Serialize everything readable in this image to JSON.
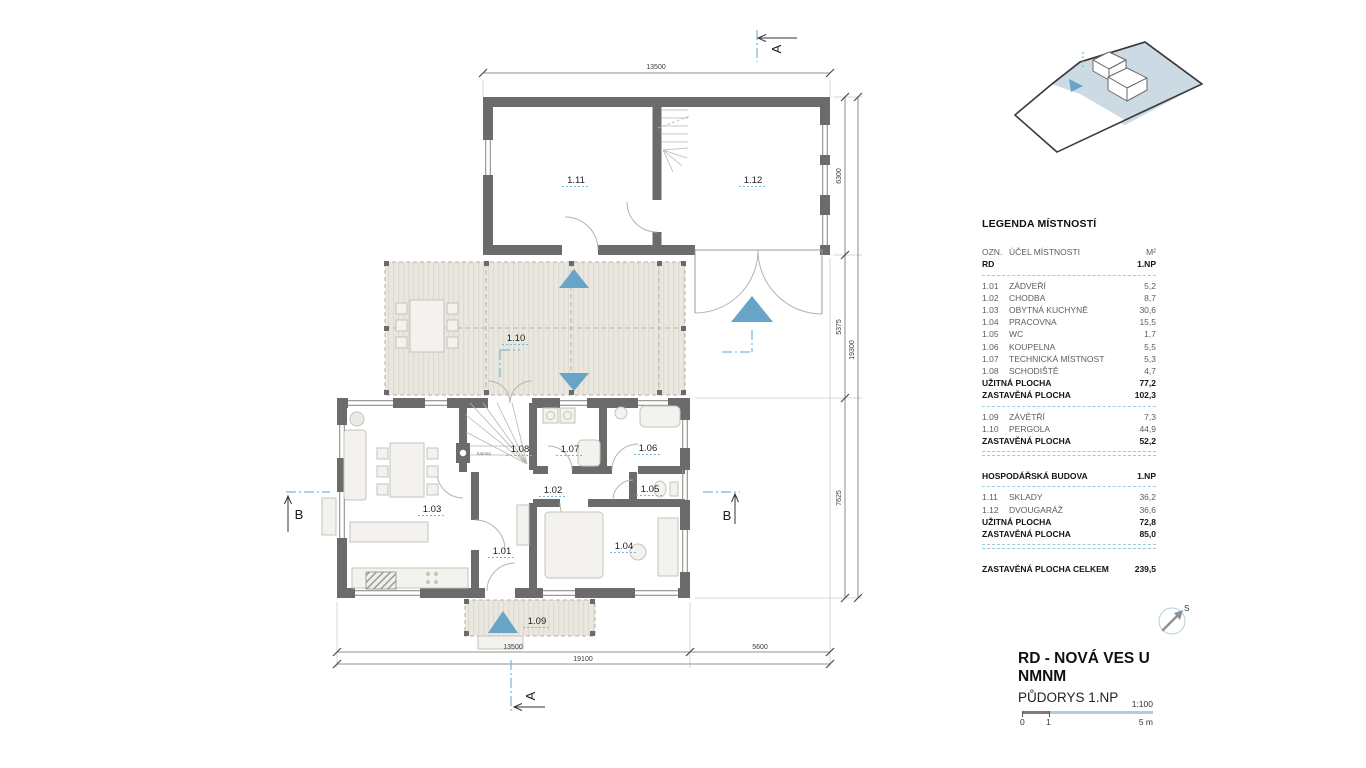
{
  "colors": {
    "wall": "#6b6b6b",
    "accent_blue": "#68a4c8",
    "reference_blue": "#79b6d9",
    "deck_fill": "#eae7e0"
  },
  "plan": {
    "rooms": {
      "r01": "1.01",
      "r02": "1.02",
      "r03": "1.03",
      "r04": "1.04",
      "r05": "1.05",
      "r06": "1.06",
      "r07": "1.07",
      "r08": "1.08",
      "r09": "1.09",
      "r10": "1.10",
      "r11": "1.11",
      "r12": "1.12"
    },
    "stove_label": "kamna",
    "dimensions": {
      "top_width": "13500",
      "right_upper": "6300",
      "right_middle": "5375",
      "right_lower": "7625",
      "right_total": "19300",
      "bottom_house": "13500",
      "bottom_gap": "5600",
      "bottom_total": "19100"
    },
    "sections": {
      "a": "A",
      "b": "B"
    }
  },
  "legend": {
    "title": "LEGENDA MÍSTNOSTÍ",
    "columns": {
      "ozn": "OZN.",
      "name": "ÚČEL MÍSTNOSTI",
      "area": "M²"
    },
    "rd": {
      "label": "RD",
      "floor": "1.NP",
      "rows": [
        {
          "code": "1.01",
          "name": "ZÁDVEŘÍ",
          "area": "5,2"
        },
        {
          "code": "1.02",
          "name": "CHODBA",
          "area": "8,7"
        },
        {
          "code": "1.03",
          "name": "OBYTNÁ KUCHYNĚ",
          "area": "30,6"
        },
        {
          "code": "1.04",
          "name": "PRACOVNA",
          "area": "15,5"
        },
        {
          "code": "1.05",
          "name": "WC",
          "area": "1,7"
        },
        {
          "code": "1.06",
          "name": "KOUPELNA",
          "area": "5,5"
        },
        {
          "code": "1.07",
          "name": "TECHNICKÁ MÍSTNOST",
          "area": "5,3"
        },
        {
          "code": "1.08",
          "name": "SCHODIŠTĚ",
          "area": "4,7"
        }
      ],
      "usable": {
        "label": "UŽITNÁ PLOCHA",
        "value": "77,2"
      },
      "builtup": {
        "label": "ZASTAVĚNÁ PLOCHA",
        "value": "102,3"
      }
    },
    "exterior": {
      "rows": [
        {
          "code": "1.09",
          "name": "ZÁVĚTŘÍ",
          "area": "7,3"
        },
        {
          "code": "1.10",
          "name": "PERGOLA",
          "area": "44,9"
        }
      ],
      "builtup": {
        "label": "ZASTAVĚNÁ PLOCHA",
        "value": "52,2"
      }
    },
    "outbuilding": {
      "label": "HOSPODÁŘSKÁ BUDOVA",
      "floor": "1.NP",
      "rows": [
        {
          "code": "1.11",
          "name": "SKLADY",
          "area": "36,2"
        },
        {
          "code": "1.12",
          "name": "DVOUGARÁŽ",
          "area": "36,6"
        }
      ],
      "usable": {
        "label": "UŽITNÁ PLOCHA",
        "value": "72,8"
      },
      "builtup": {
        "label": "ZASTAVĚNÁ PLOCHA",
        "value": "85,0"
      }
    },
    "total": {
      "label": "ZASTAVĚNÁ PLOCHA CELKEM",
      "value": "239,5"
    }
  },
  "title_block": {
    "project": "RD - NOVÁ VES U NMNM",
    "drawing": "PŮDORYS 1.NP",
    "scale_ratio": "1:100",
    "scale_zero": "0",
    "scale_one": "1",
    "scale_five": "5 m",
    "north_label": "S"
  }
}
